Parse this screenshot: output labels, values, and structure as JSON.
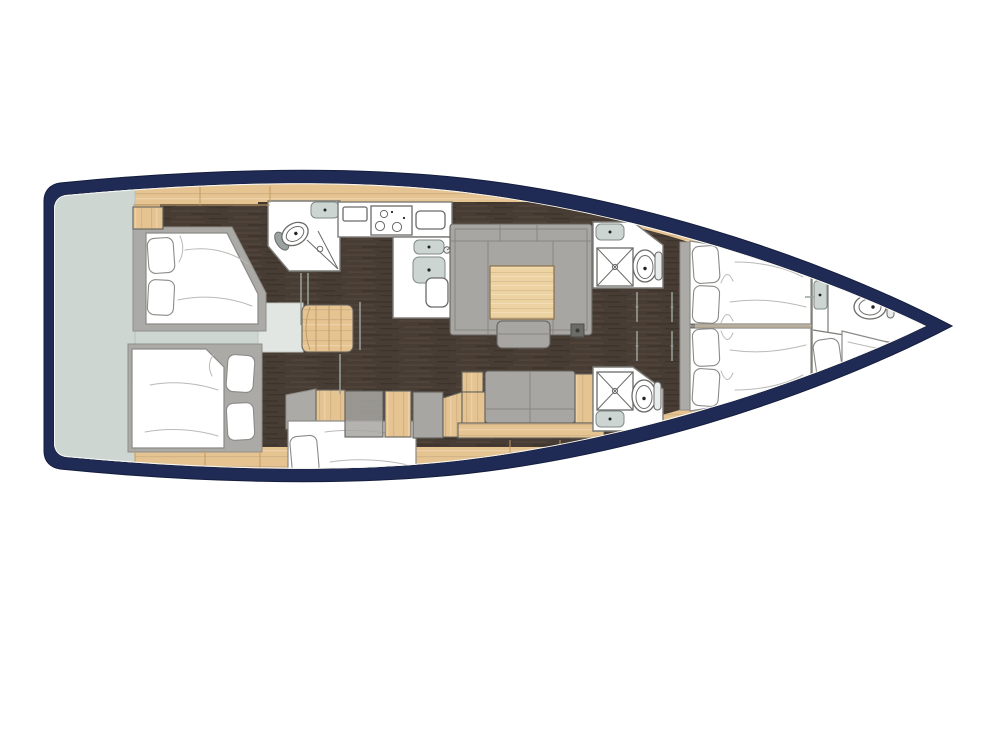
{
  "diagram": {
    "type": "yacht-interior-floor-plan",
    "orientation": "bow-right",
    "deck": "lower-deck",
    "rooms": [
      {
        "id": "swim-platform",
        "fixtures": []
      },
      {
        "id": "aft-cabin-starboard",
        "fixtures": [
          "double-bed",
          "pillows",
          "lockers"
        ]
      },
      {
        "id": "aft-cabin-port",
        "fixtures": [
          "double-bed",
          "pillows",
          "lockers"
        ]
      },
      {
        "id": "mid-cabin-port",
        "fixtures": [
          "double-bed",
          "pillow"
        ]
      },
      {
        "id": "aft-head",
        "fixtures": [
          "toilet",
          "shower",
          "sink"
        ]
      },
      {
        "id": "companionway",
        "fixtures": [
          "stairs",
          "landing"
        ]
      },
      {
        "id": "galley",
        "fixtures": [
          "three-burner-stove",
          "double-sink",
          "faucet",
          "counters"
        ]
      },
      {
        "id": "salon",
        "fixtures": [
          "u-settee",
          "dining-table",
          "stool",
          "bench-settee",
          "sideboard"
        ]
      },
      {
        "id": "head-starboard",
        "fixtures": [
          "toilet",
          "shower",
          "sink"
        ]
      },
      {
        "id": "head-port",
        "fixtures": [
          "toilet",
          "shower",
          "sink"
        ]
      },
      {
        "id": "forward-cabin",
        "fixtures": [
          "twin-berths",
          "pillows",
          "hull-shelves"
        ]
      },
      {
        "id": "bow-cabin",
        "fixtures": [
          "toilet",
          "berth",
          "door"
        ]
      }
    ]
  },
  "colors": {
    "background": "#ffffff",
    "hull": "#1f2b55",
    "hull_edge": "#141d3d",
    "deck_transom": "#cdd6d1",
    "landing": "#e2e6e3",
    "wood_base": "#e6c492",
    "table_wood": "#edd2a2",
    "wood_line": "#c19a63",
    "floor_dark": "#483d34",
    "floor_streak": "#5e5045",
    "upholstery": "#a7a6a2",
    "upholstery_seam": "#878580",
    "bed_frame": "#abaaa6",
    "mattress": "#ffffff",
    "fixture_white": "#ffffff",
    "fixture_gray": "#ccd5d1",
    "outline": "#63625e",
    "wall": "#7c7b77",
    "fold": "#b9b9b6",
    "door_line": "#9aa29c"
  }
}
